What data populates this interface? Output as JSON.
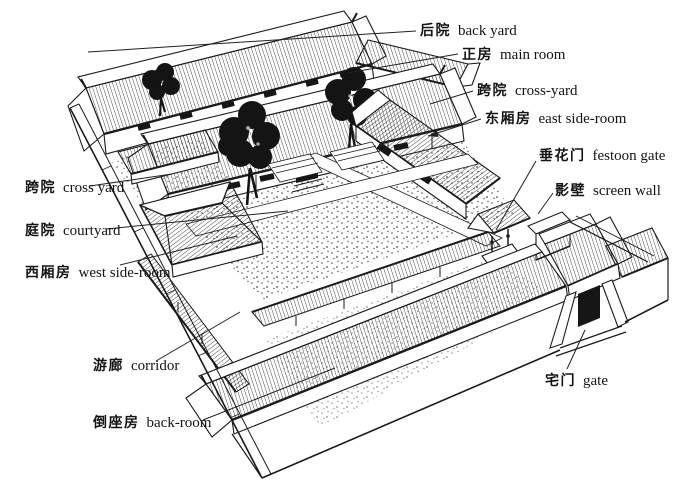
{
  "colors": {
    "ink": "#1b1b1b",
    "paper": "#ffffff"
  },
  "labels": [
    {
      "zh": "后院",
      "en": "back yard"
    },
    {
      "zh": "正房",
      "en": "main room"
    },
    {
      "zh": "跨院",
      "en": "cross-yard"
    },
    {
      "zh": "东厢房",
      "en": "east side-room"
    },
    {
      "zh": "垂花门",
      "en": "festoon gate"
    },
    {
      "zh": "影壁",
      "en": "screen wall"
    },
    {
      "zh": "跨院",
      "en": "cross yard"
    },
    {
      "zh": "庭院",
      "en": "courtyard"
    },
    {
      "zh": "西厢房",
      "en": "west side-room"
    },
    {
      "zh": "游廊",
      "en": "corridor"
    },
    {
      "zh": "倒座房",
      "en": "back-room"
    },
    {
      "zh": "宅门",
      "en": "gate"
    }
  ]
}
